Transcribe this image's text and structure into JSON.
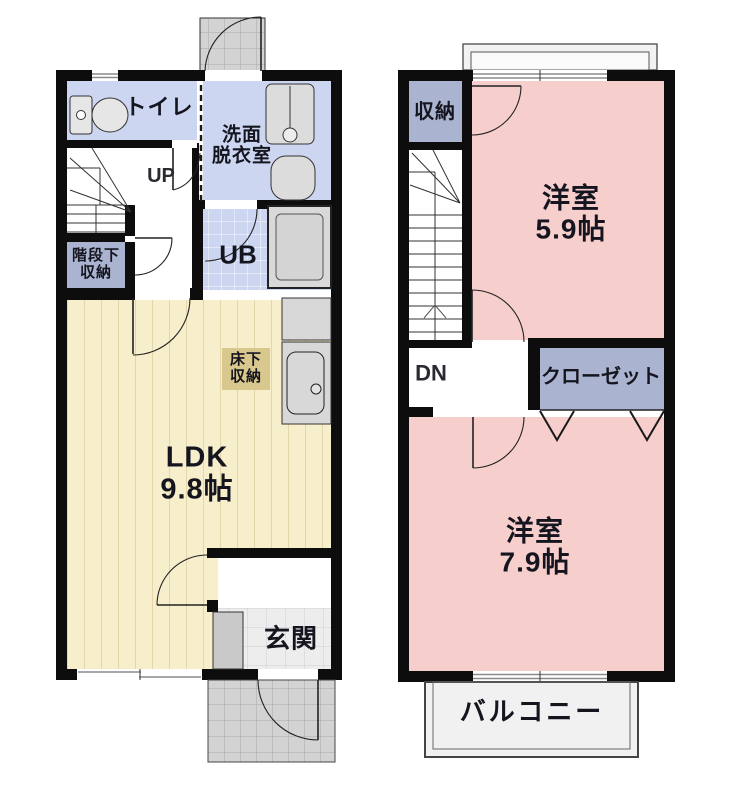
{
  "title": "floor-plan",
  "floor1": {
    "toilet": "トイレ",
    "washroom_l1": "洗面",
    "washroom_l2": "脱衣室",
    "up": "UP",
    "understairs_l1": "階段下",
    "understairs_l2": "収納",
    "ub": "UB",
    "floor_storage_l1": "床下",
    "floor_storage_l2": "収納",
    "ldk_l1": "LDK",
    "ldk_l2": "9.8帖",
    "genkan": "玄関"
  },
  "floor2": {
    "storage": "収納",
    "room1_l1": "洋室",
    "room1_l2": "5.9帖",
    "dn": "DN",
    "closet": "クローゼット",
    "room2_l1": "洋室",
    "room2_l2": "7.9帖",
    "balcony": "バルコニー"
  },
  "colors": {
    "wall": "#0d0d0d",
    "room_blue": "#ccd6f1",
    "storage_blue": "#aab3cf",
    "room_pink": "#f6cfcc",
    "ldk_cream": "#f7eecb",
    "floor_storage_tan": "#d9c88e",
    "tile_gray": "#d3d3d3",
    "tile_light": "#ededed",
    "text": "#15151f"
  }
}
